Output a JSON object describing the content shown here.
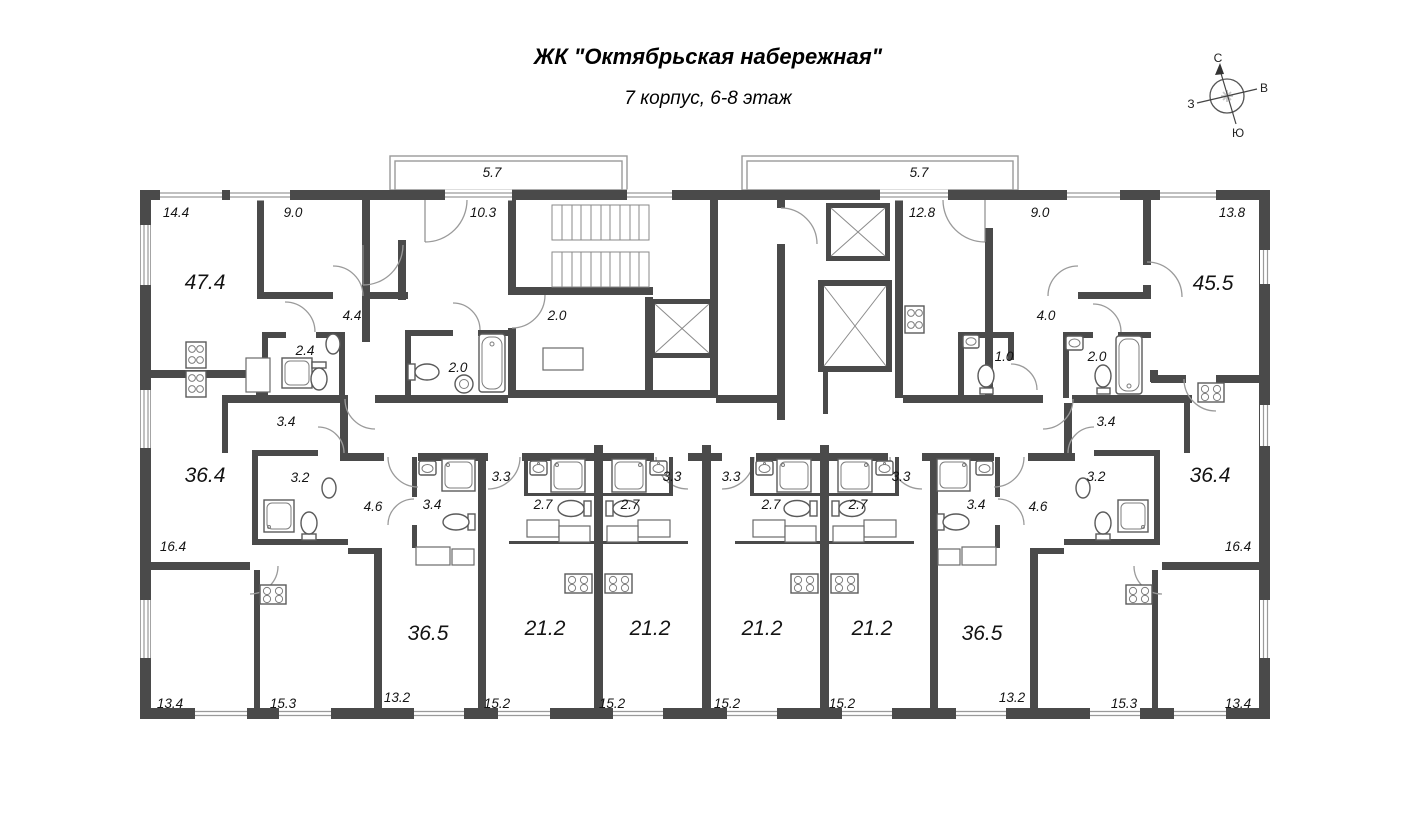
{
  "header": {
    "title": "ЖК \"Октябрьская набережная\"",
    "subtitle": "7 корпус, 6-8 этаж"
  },
  "compass": {
    "north": "С",
    "east": "В",
    "west": "З",
    "south": "Ю"
  },
  "colors": {
    "walls": "#4a4a4a",
    "thin_lines": "#9a9a9a",
    "text": "#141414"
  },
  "labels": [
    "14.4",
    "9.0",
    "47.4",
    "4.4",
    "2.4",
    "5.7",
    "10.3",
    "2.0",
    "2.0",
    "5.7",
    "12.8",
    "9.0",
    "13.8",
    "45.5",
    "4.0",
    "1.0",
    "2.0",
    "3.4",
    "3.2",
    "36.4",
    "16.4",
    "4.6",
    "3.4",
    "3.3",
    "2.7",
    "2.7",
    "3.3",
    "3.3",
    "2.7",
    "2.7",
    "3.3",
    "3.4",
    "4.6",
    "3.2",
    "3.4",
    "36.4",
    "16.4",
    "36.5",
    "21.2",
    "21.2",
    "21.2",
    "21.2",
    "36.5",
    "13.4",
    "15.3",
    "13.2",
    "15.2",
    "15.2",
    "15.2",
    "15.2",
    "13.2",
    "15.3",
    "13.4"
  ]
}
